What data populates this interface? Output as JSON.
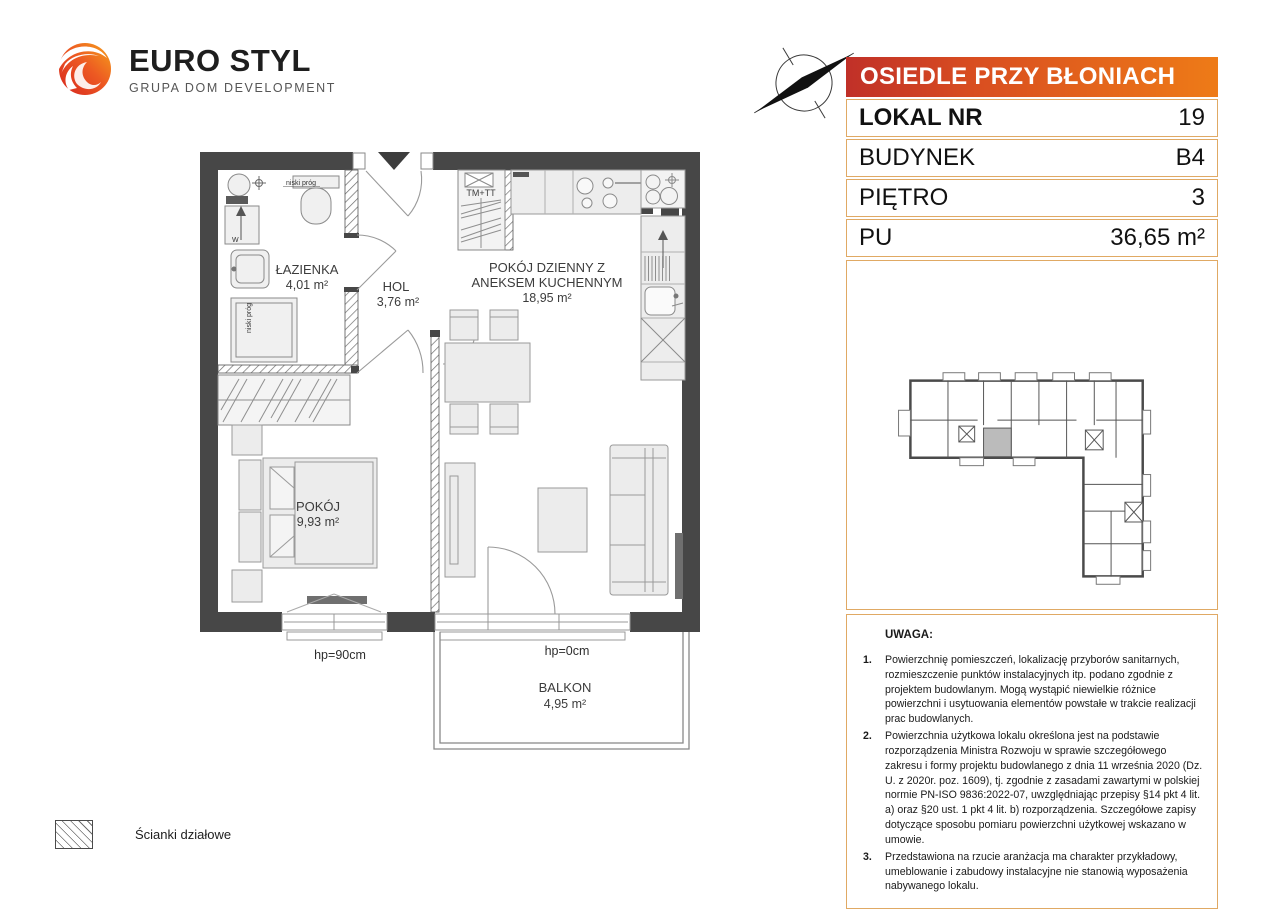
{
  "brand": {
    "name": "EURO STYL",
    "tagline": "GRUPA DOM DEVELOPMENT"
  },
  "listing": {
    "estate": "OSIEDLE PRZY BŁONIACH",
    "rows": [
      {
        "label": "LOKAL NR",
        "value": "19"
      },
      {
        "label": "BUDYNEK",
        "value": "B4"
      },
      {
        "label": "PIĘTRO",
        "value": "3"
      },
      {
        "label": "PU",
        "value": "36,65 m²"
      }
    ]
  },
  "plan": {
    "rooms": [
      {
        "name": "ŁAZIENKA",
        "area": "4,01 m²"
      },
      {
        "name": "HOL",
        "area": "3,76 m²"
      },
      {
        "name_line1": "POKÓJ DZIENNY Z",
        "name_line2": "ANEKSEM KUCHENNYM",
        "area": "18,95 m²"
      },
      {
        "name": "POKÓJ",
        "area": "9,93 m²"
      },
      {
        "name": "BALKON",
        "area": "4,95 m²"
      }
    ],
    "annotations": {
      "tm_tt": "TM+TT",
      "niski_prog_1": "niski próg",
      "niski_prog_2": "niski próg",
      "washer": "W",
      "hp_bedroom": "hp=90cm",
      "hp_balcony": "hp=0cm"
    }
  },
  "legend": {
    "partition_walls": "Ścianki działowe"
  },
  "notes": {
    "title": "UWAGA:",
    "items": [
      "Powierzchnię pomieszczeń, lokalizację przyborów sanitarnych, rozmieszczenie punktów instalacyjnych itp. podano zgodnie z projektem budowlanym. Mogą wystąpić niewielkie różnice powierzchni i usytuowania elementów powstałe w trakcie realizacji prac budowlanych.",
      "Powierzchnia użytkowa lokalu określona jest na podstawie rozporządzenia Ministra Rozwoju w sprawie szczegółowego zakresu i formy projektu budowlanego z dnia 11 września 2020 (Dz. U. z 2020r. poz. 1609), tj. zgodnie z zasadami zawartymi w polskiej normie PN-ISO 9836:2022-07, uwzględniając przepisy §14 pkt 4 lit. a) oraz §20 ust. 1 pkt 4 lit. b) rozporządzenia. Szczegółowe zapisy dotyczące sposobu pomiaru powierzchni użytkowej wskazano w umowie.",
      "Przedstawiona na rzucie aranżacja ma charakter przykładowy, umeblowanie i zabudowy instalacyjne nie stanowią wyposażenia nabywanego lokalu."
    ]
  },
  "colors": {
    "wall": "#474747",
    "accent_red": "#c03028",
    "accent_orange": "#ee7b17",
    "table_border": "#e0a964",
    "unit_highlight": "#bbbbbb"
  }
}
